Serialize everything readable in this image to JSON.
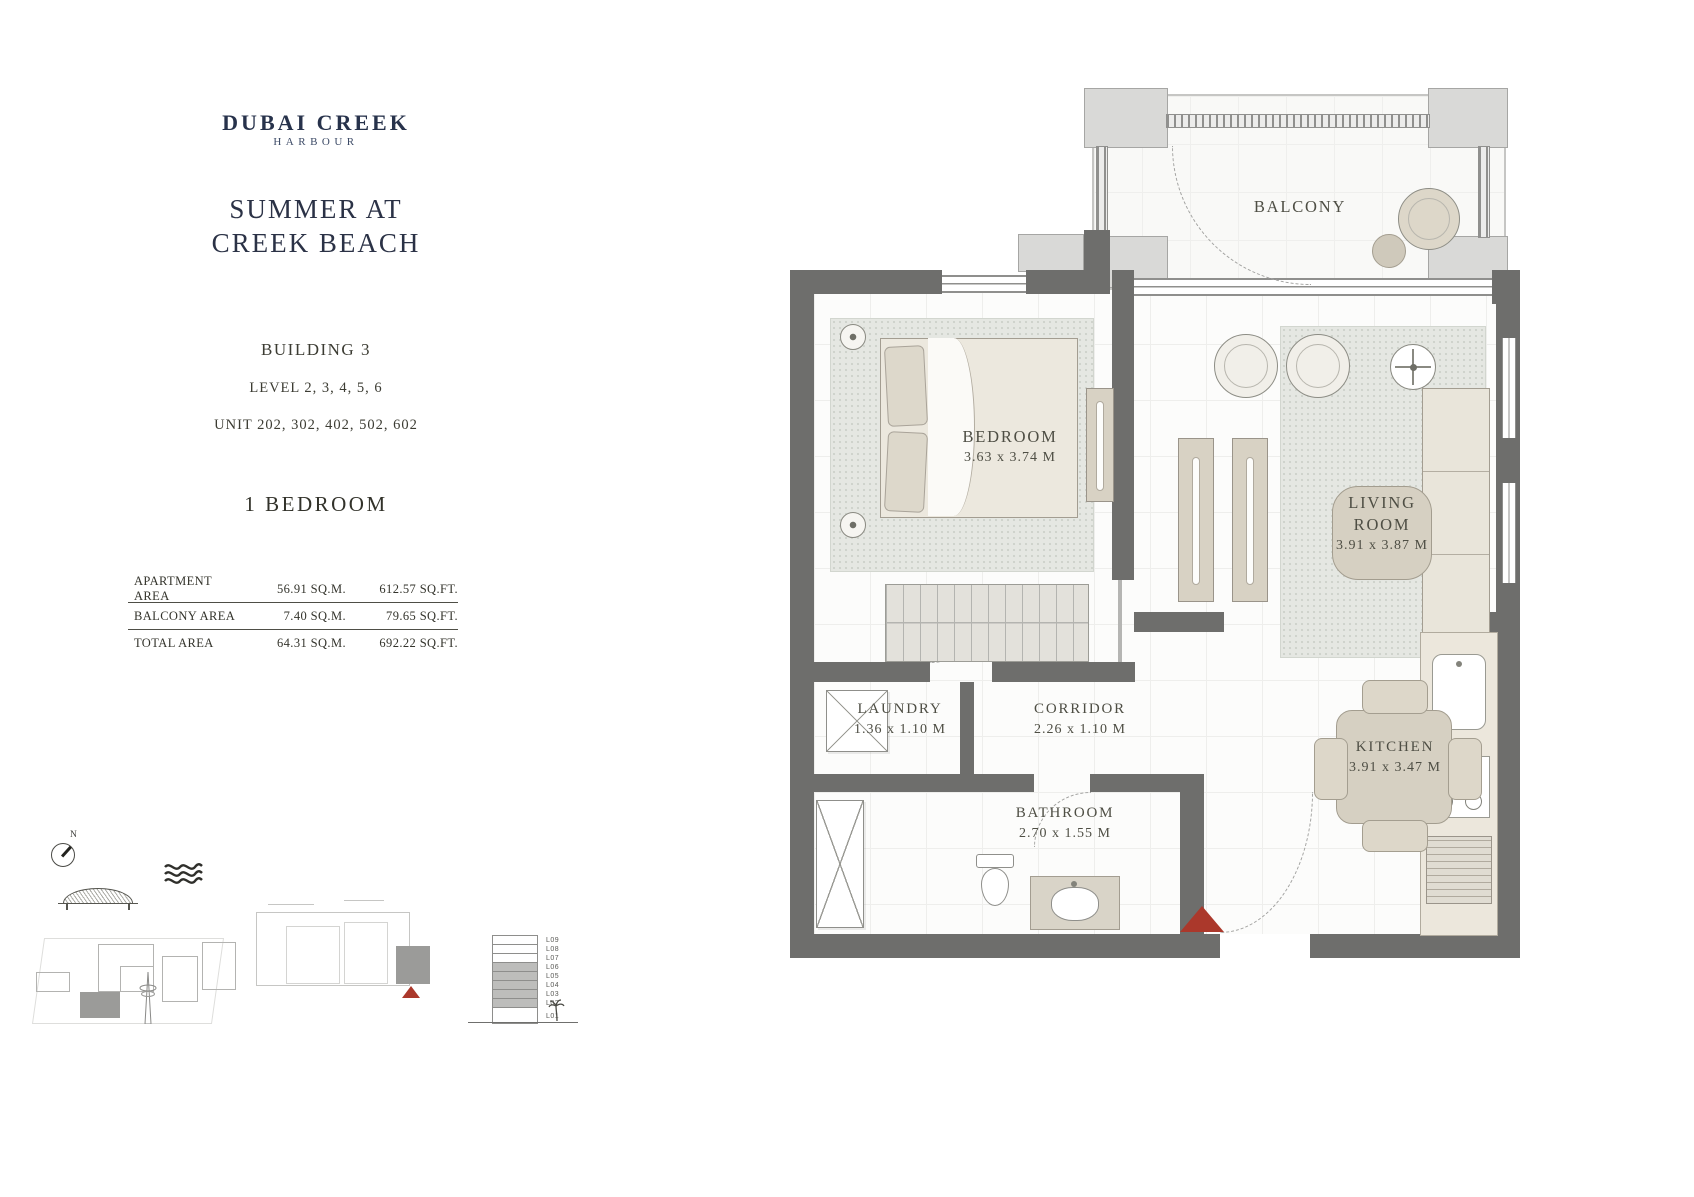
{
  "brand": {
    "name": "DUBAI CREEK",
    "tagline": "HARBOUR"
  },
  "title": {
    "line1": "SUMMER AT",
    "line2": "CREEK BEACH"
  },
  "unit_info": {
    "building": "BUILDING 3",
    "levels": "LEVEL 2, 3, 4, 5, 6",
    "units": "UNIT 202, 302, 402, 502, 602",
    "bedroom_type": "1 BEDROOM"
  },
  "area_table": {
    "rows": [
      {
        "label": "APARTMENT AREA",
        "sqm": "56.91 SQ.M.",
        "sqft": "612.57 SQ.FT."
      },
      {
        "label": "BALCONY AREA",
        "sqm": "7.40 SQ.M.",
        "sqft": "79.65 SQ.FT."
      },
      {
        "label": "TOTAL AREA",
        "sqm": "64.31 SQ.M.",
        "sqft": "692.22 SQ.FT."
      }
    ]
  },
  "floor_plan": {
    "rooms": {
      "balcony": {
        "name": "BALCONY"
      },
      "bedroom": {
        "name": "BEDROOM",
        "dims": "3.63 x 3.74 M"
      },
      "living_room": {
        "name_line1": "LIVING",
        "name_line2": "ROOM",
        "dims": "3.91 x 3.87 M"
      },
      "laundry": {
        "name": "LAUNDRY",
        "dims": "1.36 x 1.10 M"
      },
      "corridor": {
        "name": "CORRIDOR",
        "dims": "2.26 x 1.10 M"
      },
      "kitchen": {
        "name": "KITCHEN",
        "dims": "3.91 x 3.47 M"
      },
      "bathroom": {
        "name": "BATHROOM",
        "dims": "2.70 x 1.55 M"
      }
    }
  },
  "key_diagrams": {
    "compass_label": "N",
    "level_stack": {
      "levels": [
        "L09",
        "L08",
        "L07",
        "L06",
        "L05",
        "L04",
        "L03",
        "L02",
        "L01"
      ],
      "highlighted_levels": [
        "L06",
        "L05",
        "L04",
        "L03",
        "L02"
      ]
    }
  },
  "colors": {
    "brand_navy": "#27324b",
    "text": "#3f3f37",
    "wall_gray": "#6e6e6c",
    "light_block": "#d9d9d7",
    "furniture_beige": "#d8d2c4",
    "accent_red": "#ab382b"
  }
}
